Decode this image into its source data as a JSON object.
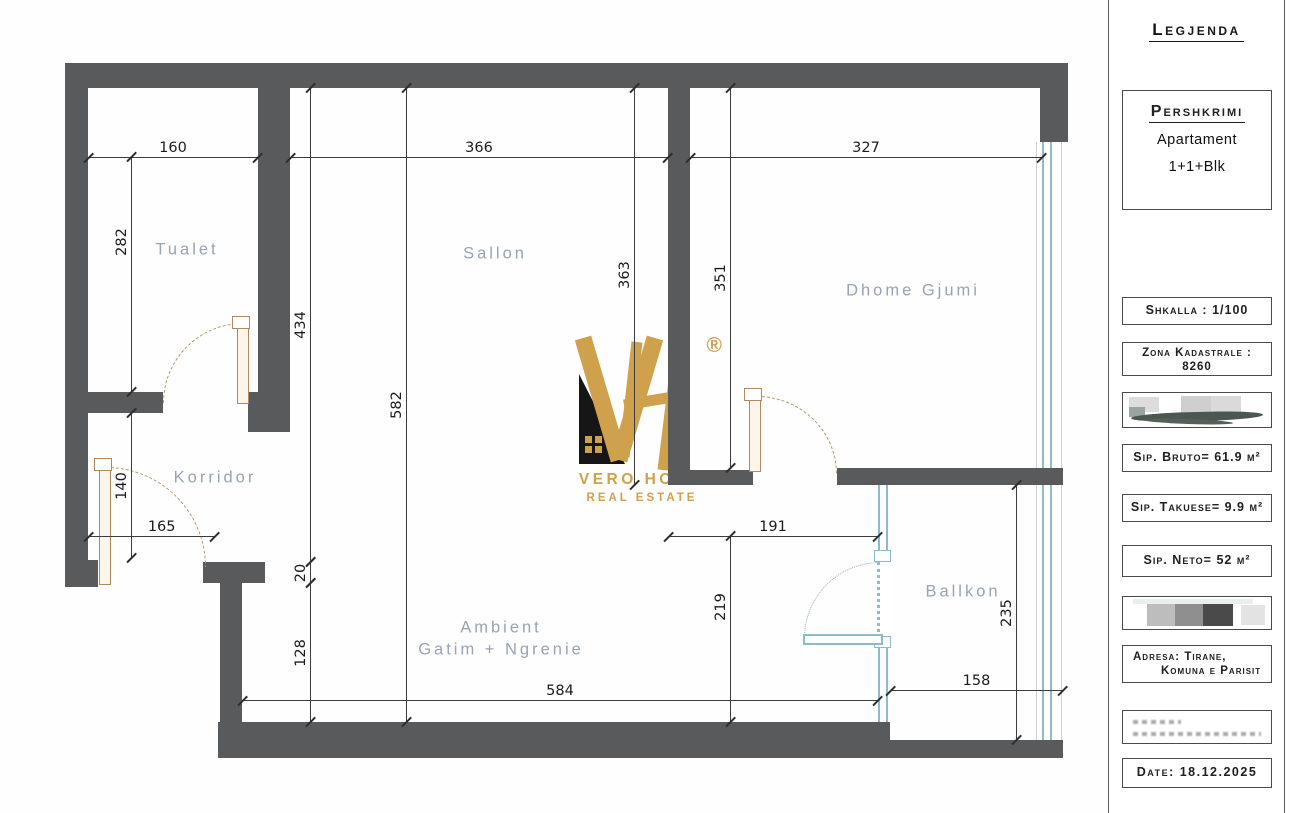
{
  "sidebar": {
    "title": "Legjenda",
    "pershkrimi": {
      "title": "Pershkrimi",
      "type_line1": "Apartament",
      "type_line2": "1+1+Blk"
    },
    "shkalla": "Shkalla : 1/100",
    "zona": {
      "line1": "Zona Kadastrale :",
      "line2": "8260"
    },
    "bruto": "Sip. Bruto= 61.9 m²",
    "takuese": "Sip. Takuese= 9.9 m²",
    "neto": "Sip. Neto= 52 m²",
    "adresa": {
      "line1": "Adresa: Tirane,",
      "line2": "Komuna e Parisit"
    },
    "date": "Date: 18.12.2025"
  },
  "plan": {
    "rooms": [
      {
        "name": "Tualet"
      },
      {
        "name": "Sallon"
      },
      {
        "name": "Dhome Gjumi"
      },
      {
        "name": "Korridor"
      },
      {
        "line1": "Ambient",
        "line2": "Gatim + Ngrenie"
      },
      {
        "name": "Ballkon"
      }
    ],
    "dimensions": [
      {
        "value": "160"
      },
      {
        "value": "366"
      },
      {
        "value": "327"
      },
      {
        "value": "282"
      },
      {
        "value": "140"
      },
      {
        "value": "434"
      },
      {
        "value": "20"
      },
      {
        "value": "128"
      },
      {
        "value": "582"
      },
      {
        "value": "363"
      },
      {
        "value": "351"
      },
      {
        "value": "165"
      },
      {
        "value": "191"
      },
      {
        "value": "219"
      },
      {
        "value": "584"
      },
      {
        "value": "235"
      },
      {
        "value": "158"
      }
    ]
  },
  "logo": {
    "brand": "VERO HOME",
    "tagline": "REAL ESTATE",
    "registered": "®"
  },
  "colors": {
    "wall": "#595a5c",
    "glass": "#8fbac9",
    "door": "#b08a5e",
    "gold": "#cfa14c",
    "room_label": "#98a3b4"
  }
}
